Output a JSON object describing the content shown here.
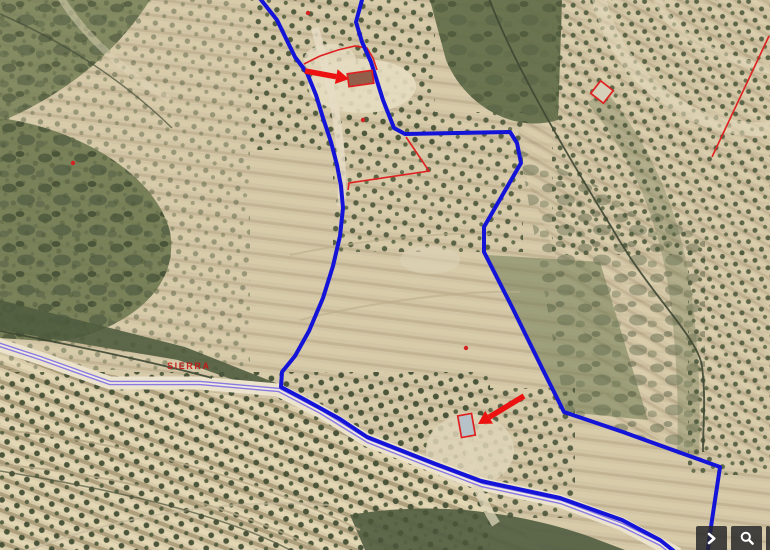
{
  "map": {
    "place_label": {
      "text": "SIERRA",
      "x": 167,
      "y": 361,
      "color": "#c81414"
    },
    "colors": {
      "boundary_blue": "#1414d8",
      "road_purple": "#8a79e2",
      "road_center": "#f1ece0",
      "cadastral_red": "#e02020",
      "arrow_red": "#ec1212",
      "marker_red": "#d42222"
    },
    "boundary_lines": [
      [
        [
          258,
          -4
        ],
        [
          277,
          20
        ],
        [
          295,
          57
        ],
        [
          307,
          73
        ],
        [
          316,
          95
        ],
        [
          323,
          118
        ],
        [
          331,
          142
        ],
        [
          337,
          165
        ],
        [
          341,
          186
        ],
        [
          343,
          208
        ],
        [
          340,
          236
        ],
        [
          333,
          266
        ],
        [
          323,
          298
        ],
        [
          309,
          331
        ],
        [
          295,
          356
        ],
        [
          282,
          372
        ],
        [
          281,
          387
        ],
        [
          300,
          397
        ],
        [
          340,
          419
        ],
        [
          367,
          437
        ],
        [
          433,
          463
        ],
        [
          481,
          481
        ],
        [
          560,
          498
        ],
        [
          622,
          520
        ],
        [
          660,
          540
        ],
        [
          680,
          556
        ]
      ],
      [
        [
          363,
          -4
        ],
        [
          356,
          22
        ],
        [
          362,
          42
        ],
        [
          371,
          62
        ],
        [
          383,
          100
        ],
        [
          394,
          128
        ],
        [
          405,
          134
        ],
        [
          510,
          132
        ],
        [
          517,
          143
        ],
        [
          521,
          163
        ],
        [
          484,
          227
        ],
        [
          484,
          252
        ],
        [
          512,
          307
        ],
        [
          543,
          370
        ],
        [
          564,
          412
        ],
        [
          623,
          432
        ],
        [
          720,
          467
        ],
        [
          712,
          520
        ],
        [
          707,
          556
        ]
      ]
    ],
    "road_line": [
      [
        -3,
        344
      ],
      [
        40,
        358
      ],
      [
        110,
        383
      ],
      [
        200,
        383
      ],
      [
        279,
        390
      ],
      [
        321,
        412
      ],
      [
        368,
        441
      ],
      [
        434,
        467
      ],
      [
        482,
        485
      ],
      [
        561,
        502
      ],
      [
        622,
        525
      ],
      [
        661,
        544
      ],
      [
        676,
        556
      ]
    ],
    "red_parcel_lines": [
      [
        [
          406,
          137
        ],
        [
          429,
          171
        ],
        [
          349,
          183
        ],
        [
          348,
          190
        ]
      ],
      [
        [
          304,
          64
        ],
        [
          320,
          56
        ],
        [
          338,
          50
        ],
        [
          355,
          46
        ],
        [
          367,
          48
        ],
        [
          373,
          58
        ],
        [
          377,
          70
        ]
      ],
      [
        [
          769,
          36
        ],
        [
          712,
          157
        ]
      ]
    ],
    "buildings": [
      {
        "name": "building-outline-north",
        "cx": 360.5,
        "cy": 78.5,
        "w": 25,
        "h": 13,
        "rot": -8,
        "roof": "#92604a"
      },
      {
        "name": "building-outline-south",
        "cx": 466.5,
        "cy": 425.5,
        "w": 14,
        "h": 22,
        "rot": -10,
        "roof": "#b6c2c8"
      },
      {
        "name": "building-outline-east",
        "cx": 602,
        "cy": 92,
        "w": 16,
        "h": 16,
        "rot": 38,
        "roof": "#d6cfba"
      }
    ],
    "arrows": [
      {
        "name": "arrow-to-north-building",
        "tail": [
          305,
          71
        ],
        "tip": [
          349,
          79
        ]
      },
      {
        "name": "arrow-to-south-building",
        "tail": [
          524,
          396
        ],
        "tip": [
          478,
          424
        ]
      }
    ],
    "markers": [
      [
        73,
        163
      ],
      [
        308,
        13
      ],
      [
        363,
        120
      ],
      [
        466,
        348
      ]
    ]
  },
  "toolbar": {
    "buttons": [
      {
        "name": "pan-right",
        "icon": "chevron-right-icon"
      },
      {
        "name": "zoom",
        "icon": "magnifier-icon"
      },
      {
        "name": "partial-hidden",
        "icon": "none"
      }
    ]
  }
}
